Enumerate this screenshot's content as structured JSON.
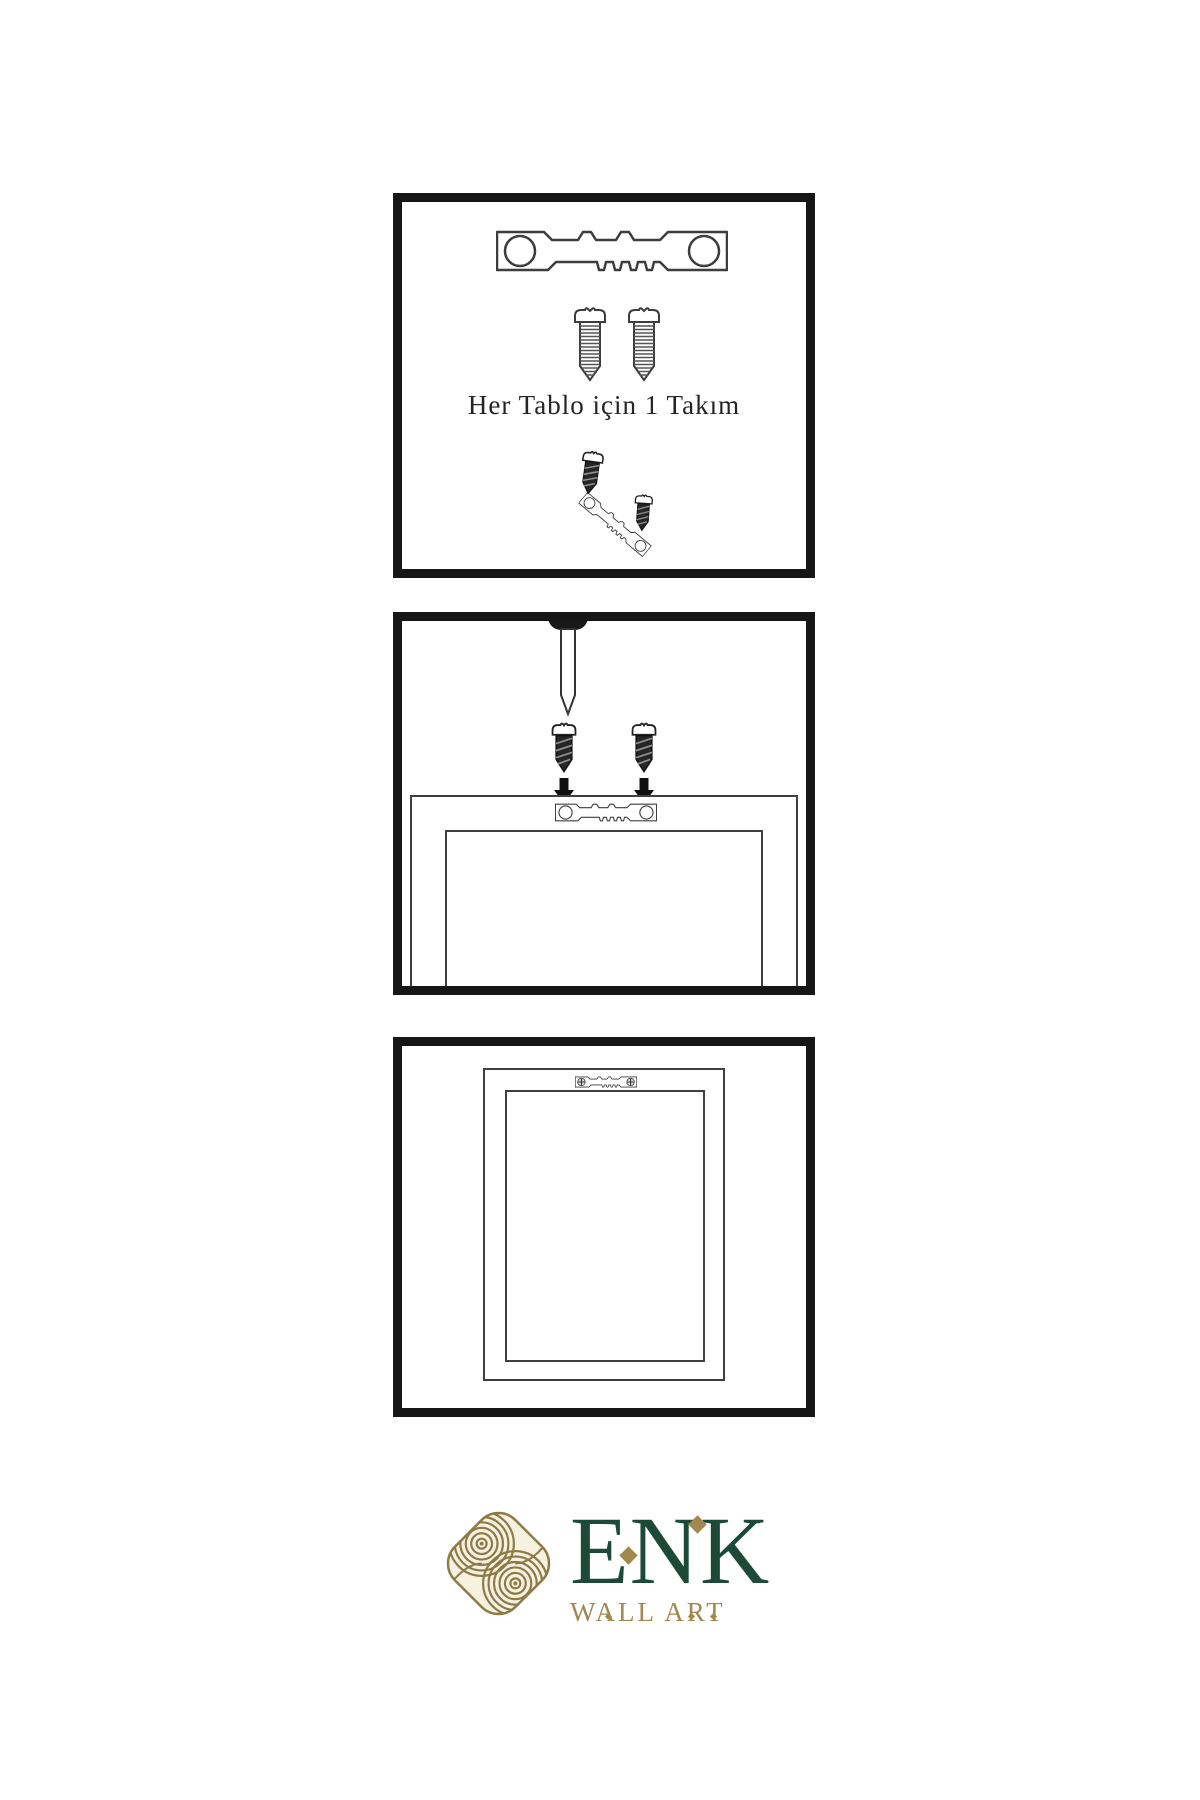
{
  "step1": {
    "caption": "Her Tablo için 1 Takım"
  },
  "brand": {
    "name": "ENK",
    "subtitle": "WALL ART"
  },
  "colors": {
    "panel_border": "#161616",
    "line_art": "#3d3d3d",
    "dark_fill": "#1a1a1a",
    "brand_green": "#1d4a38",
    "brand_gold": "#a0884f",
    "knot_gold": "#8d7a45",
    "knot_cream": "#f7f1e1",
    "background": "#ffffff"
  },
  "icons": {
    "sawtooth-hanger": "sawtooth picture hanger bracket with two screw holes",
    "screw": "outlined threaded screw",
    "dark-screw": "small dark screw",
    "nail": "wall nail with dark head",
    "down-arrow": "solid black downward arrow",
    "hanger-screwed": "sawtooth hanger fastened with two cross-head screws",
    "knot-logo": "interlaced gold knot emblem on cream rounded diamond",
    "diamond": "gold diamond accent"
  }
}
